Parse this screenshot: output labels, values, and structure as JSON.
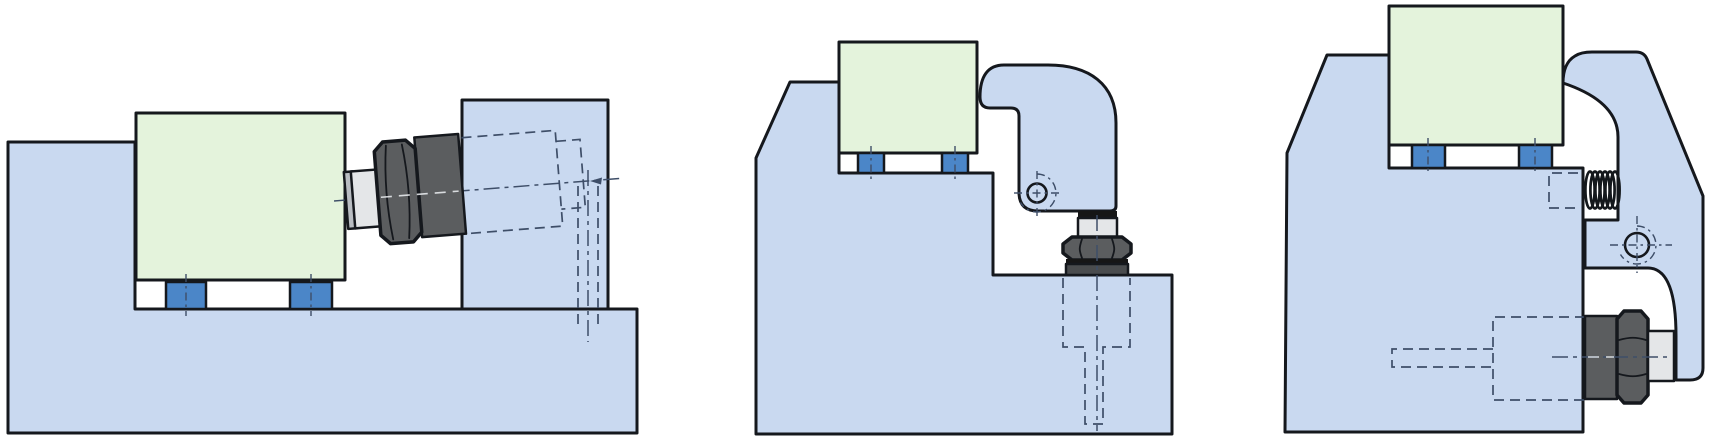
{
  "meta": {
    "width": 1719,
    "height": 445,
    "kind": "technical-mounting-diagram",
    "figure_count": 3
  },
  "palette": {
    "page_bg": "#ffffff",
    "fixture_blue": "#c9d9f0",
    "sensor_green": "#e4f3dc",
    "foot_blue": "#4b86c8",
    "metal_dark": "#5b5d5f",
    "metal_darker": "#4a4c4e",
    "metal_light": "#e4e6e8",
    "metal_cap": "#b9bdc2",
    "black_band": "#161616",
    "outline": "#15181d",
    "hidden_line": "#3e4e68",
    "spring_black": "#14181c",
    "axis_highlight": "#eef1f5"
  },
  "figures": [
    {
      "id": "figure-1-horizontal-wall-mount",
      "parts": [
        "base-plate",
        "side-wall",
        "sensor-block",
        "mounting-foot",
        "mounting-foot",
        "cable-connector",
        "hidden-bore",
        "axis-centerline"
      ]
    },
    {
      "id": "figure-2-hook-clamp-mount",
      "parts": [
        "wedge-base",
        "sensor-block",
        "mounting-foot",
        "mounting-foot",
        "hook-clamp-arm",
        "pivot-hole",
        "cable-connector",
        "hidden-tapped-hole"
      ]
    },
    {
      "id": "figure-3-c-clamp-spring-mount",
      "parts": [
        "wedge-base",
        "sensor-block",
        "mounting-foot",
        "mounting-foot",
        "c-clamp-arm",
        "preload-spring",
        "pivot-hole",
        "cable-connector",
        "hidden-bore"
      ]
    }
  ]
}
